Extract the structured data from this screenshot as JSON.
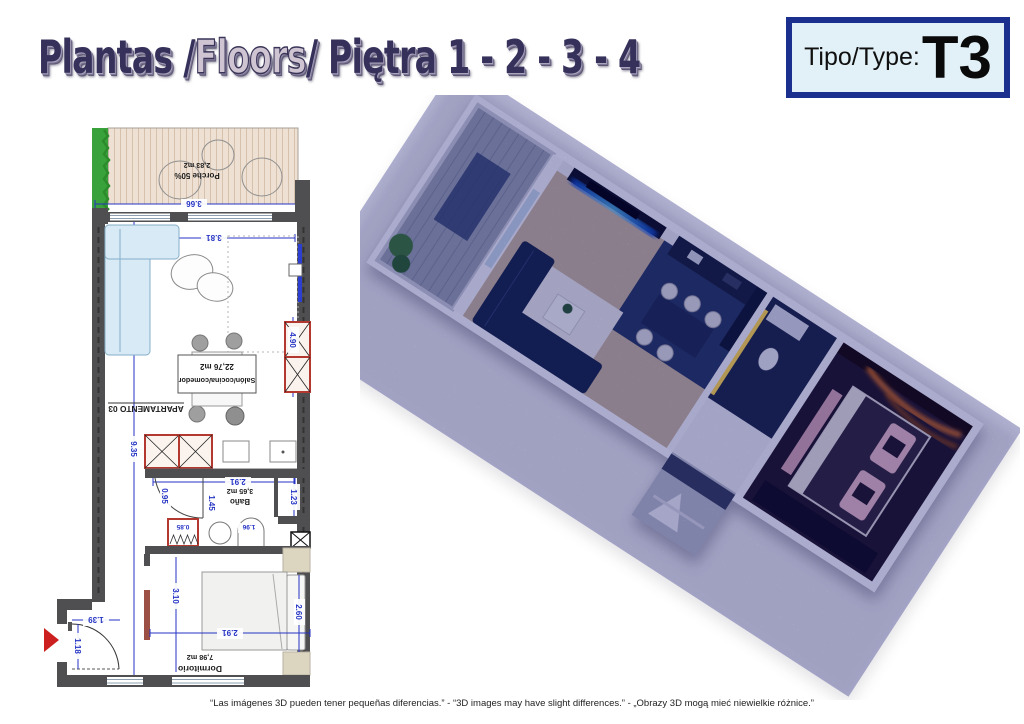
{
  "page": {
    "title": {
      "part1": "Plantas / ",
      "part2": "Floors",
      "part3": " / Piętra 1 - 2 - 3 - 4"
    },
    "type_box": {
      "label": "Tipo/Type:",
      "value": "T3"
    },
    "footer_disclaimer": "“Las imágenes 3D pueden tener pequeñas diferencias.” - “3D images may have slight differences.” - „Obrazy 3D mogą mieć niewielkie różnice.”"
  },
  "floor_plan": {
    "apartment_label": "APARTAMENTO 03",
    "rooms": {
      "porch": {
        "name": "Porche 50%",
        "area": "2,83 m2"
      },
      "living": {
        "name": "Salón/cocina/comedor",
        "area": "22,76 m2"
      },
      "bath": {
        "name": "Baño",
        "area": "3,65 m2"
      },
      "bedroom": {
        "name": "Dormitorio",
        "area": "7,98 m2"
      }
    },
    "dimensions": {
      "porch_width": "3.66",
      "living_width": "3.81",
      "apartment_depth": "9.35",
      "right_windows": "4.90",
      "kitchen_width": "2.91",
      "hall_door": "0.95",
      "bath_depth": "1.45",
      "shower_width": "1.23",
      "closet_width": "0.85",
      "bath_width": "1.96",
      "bedroom_width": "2.91",
      "bedroom_depth": "3.10",
      "bed_wall": "2.60",
      "entry_width": "1.39",
      "entry_door": "1.18"
    }
  },
  "render_3d": {
    "colors": {
      "tv_led": "#2f8bff",
      "bedroom_led": "#e07818",
      "sofa": "#1b2a46",
      "pillows": "#e5b9c0",
      "floor_wood": "#c9b69b",
      "floor_dark": "#2b3c5e"
    }
  }
}
